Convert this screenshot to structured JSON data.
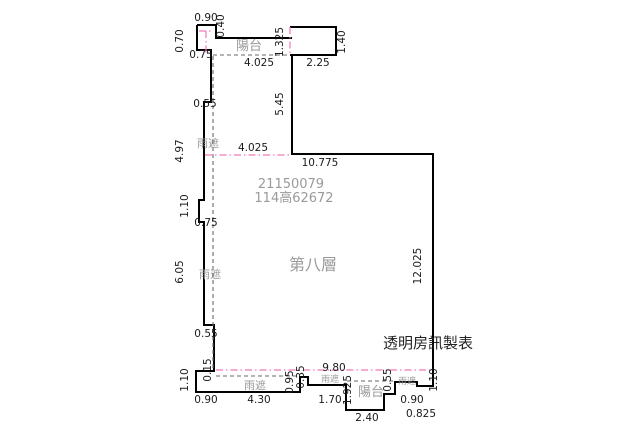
{
  "plan": {
    "floor_label": "第八層",
    "registration_numbers": [
      "21150079",
      "114高62672"
    ],
    "producer_note": "透明房訊製表",
    "area_names": {
      "balcony": "陽台",
      "rain_eave": "雨遮"
    }
  },
  "colors": {
    "background": "#ffffff",
    "wall": "#000000",
    "dimension_text": "#1a1a1a",
    "gray_text": "#9a9a9a",
    "pink_line": "#f07ab8",
    "dash_line": "#6a6a6a",
    "black_text": "#222222"
  },
  "labels": [
    {
      "name": "dim-0-90-top",
      "text": "0.90",
      "x": 206,
      "y": 21,
      "rot": 0,
      "style": "dim"
    },
    {
      "name": "dim-0-40",
      "text": "0.40",
      "x": 224,
      "y": 26,
      "rot": -90,
      "style": "dim"
    },
    {
      "name": "dim-0-70",
      "text": "0.70",
      "x": 183,
      "y": 41,
      "rot": -90,
      "style": "dim"
    },
    {
      "name": "dim-0-75-top",
      "text": "0.75",
      "x": 201,
      "y": 58,
      "rot": 0,
      "style": "dim"
    },
    {
      "name": "label-balcony-top",
      "text": "陽台",
      "x": 249,
      "y": 50,
      "rot": 0,
      "style": "gray"
    },
    {
      "name": "dim-1-325",
      "text": "1.325",
      "x": 283,
      "y": 42,
      "rot": -90,
      "style": "dim"
    },
    {
      "name": "dim-4-025-top",
      "text": "4.025",
      "x": 259,
      "y": 66,
      "rot": 0,
      "style": "dim"
    },
    {
      "name": "dim-2-25",
      "text": "2.25",
      "x": 318,
      "y": 66,
      "rot": 0,
      "style": "dim"
    },
    {
      "name": "dim-1-40",
      "text": "1.40",
      "x": 345,
      "y": 42,
      "rot": -90,
      "style": "dim"
    },
    {
      "name": "dim-0-55-left1",
      "text": "0.55",
      "x": 205,
      "y": 107,
      "rot": 0,
      "style": "dim"
    },
    {
      "name": "dim-5-45",
      "text": "5.45",
      "x": 283,
      "y": 104,
      "rot": -90,
      "style": "dim"
    },
    {
      "name": "label-eave-left1",
      "text": "雨遮",
      "x": 208,
      "y": 147,
      "rot": 0,
      "style": "gray-sm"
    },
    {
      "name": "dim-4-025-mid",
      "text": "4.025",
      "x": 253,
      "y": 151,
      "rot": 0,
      "style": "dim"
    },
    {
      "name": "dim-4-97",
      "text": "4.97",
      "x": 183,
      "y": 151,
      "rot": -90,
      "style": "dim"
    },
    {
      "name": "dim-10-775",
      "text": "10.775",
      "x": 320,
      "y": 166,
      "rot": 0,
      "style": "dim"
    },
    {
      "name": "label-reg-number-1",
      "text": "21150079",
      "x": 291,
      "y": 188,
      "rot": 0,
      "style": "gray"
    },
    {
      "name": "label-reg-number-2",
      "text": "114高62672",
      "x": 294,
      "y": 202,
      "rot": 0,
      "style": "gray"
    },
    {
      "name": "dim-1-10-left1",
      "text": "1.10",
      "x": 188,
      "y": 206,
      "rot": -90,
      "style": "dim"
    },
    {
      "name": "dim-0-75-mid",
      "text": "0.75",
      "x": 206,
      "y": 226,
      "rot": 0,
      "style": "dim"
    },
    {
      "name": "dim-6-05",
      "text": "6.05",
      "x": 183,
      "y": 272,
      "rot": -90,
      "style": "dim"
    },
    {
      "name": "label-eave-left2",
      "text": "雨遮",
      "x": 210,
      "y": 278,
      "rot": 0,
      "style": "gray-sm"
    },
    {
      "name": "label-floor",
      "text": "第八層",
      "x": 313,
      "y": 270,
      "rot": 0,
      "style": "gray-lg"
    },
    {
      "name": "dim-12-025",
      "text": "12.025",
      "x": 421,
      "y": 266,
      "rot": -90,
      "style": "dim"
    },
    {
      "name": "dim-0-55-left2",
      "text": "0.55",
      "x": 206,
      "y": 337,
      "rot": 0,
      "style": "dim"
    },
    {
      "name": "label-producer",
      "text": "透明房訊製表",
      "x": 428,
      "y": 348,
      "rot": 0,
      "style": "black"
    },
    {
      "name": "dim-0-15",
      "text": "0.15",
      "x": 211,
      "y": 370,
      "rot": -90,
      "style": "dim"
    },
    {
      "name": "dim-1-10-left2",
      "text": "1.10",
      "x": 188,
      "y": 380,
      "rot": -90,
      "style": "dim"
    },
    {
      "name": "dim-0-90-bottom-left",
      "text": "0.90",
      "x": 206,
      "y": 403,
      "rot": 0,
      "style": "dim"
    },
    {
      "name": "dim-4-30",
      "text": "4.30",
      "x": 259,
      "y": 403,
      "rot": 0,
      "style": "dim"
    },
    {
      "name": "label-eave-bottom1",
      "text": "雨遮",
      "x": 255,
      "y": 389,
      "rot": 0,
      "style": "gray-sm"
    },
    {
      "name": "dim-0-95",
      "text": "0.95",
      "x": 293,
      "y": 382,
      "rot": -90,
      "style": "dim"
    },
    {
      "name": "dim-0-35",
      "text": "0.35",
      "x": 304,
      "y": 377,
      "rot": -90,
      "style": "dim"
    },
    {
      "name": "dim-9-80",
      "text": "9.80",
      "x": 334,
      "y": 371,
      "rot": 0,
      "style": "dim"
    },
    {
      "name": "label-eave-bottom2",
      "text": "雨遮",
      "x": 330,
      "y": 382,
      "rot": 0,
      "style": "gray-xs"
    },
    {
      "name": "dim-1-70",
      "text": "1.70",
      "x": 330,
      "y": 403,
      "rot": 0,
      "style": "dim"
    },
    {
      "name": "dim-1-925",
      "text": "1.925",
      "x": 351,
      "y": 390,
      "rot": -90,
      "style": "dim"
    },
    {
      "name": "label-balcony-bottom",
      "text": "陽台",
      "x": 371,
      "y": 396,
      "rot": 0,
      "style": "gray"
    },
    {
      "name": "dim-0-55-balcony",
      "text": "0.55",
      "x": 391,
      "y": 380,
      "rot": -90,
      "style": "dim"
    },
    {
      "name": "label-eave-bottom3",
      "text": "雨遮",
      "x": 407,
      "y": 384,
      "rot": 0,
      "style": "gray-xs"
    },
    {
      "name": "dim-0-90-bottom-right",
      "text": "0.90",
      "x": 412,
      "y": 403,
      "rot": 0,
      "style": "dim"
    },
    {
      "name": "dim-2-40",
      "text": "2.40",
      "x": 367,
      "y": 421,
      "rot": 0,
      "style": "dim"
    },
    {
      "name": "dim-0-825",
      "text": "0.825",
      "x": 421,
      "y": 417,
      "rot": 0,
      "style": "dim"
    },
    {
      "name": "dim-1-10-right",
      "text": "1.10",
      "x": 437,
      "y": 380,
      "rot": -90,
      "style": "dim"
    }
  ]
}
